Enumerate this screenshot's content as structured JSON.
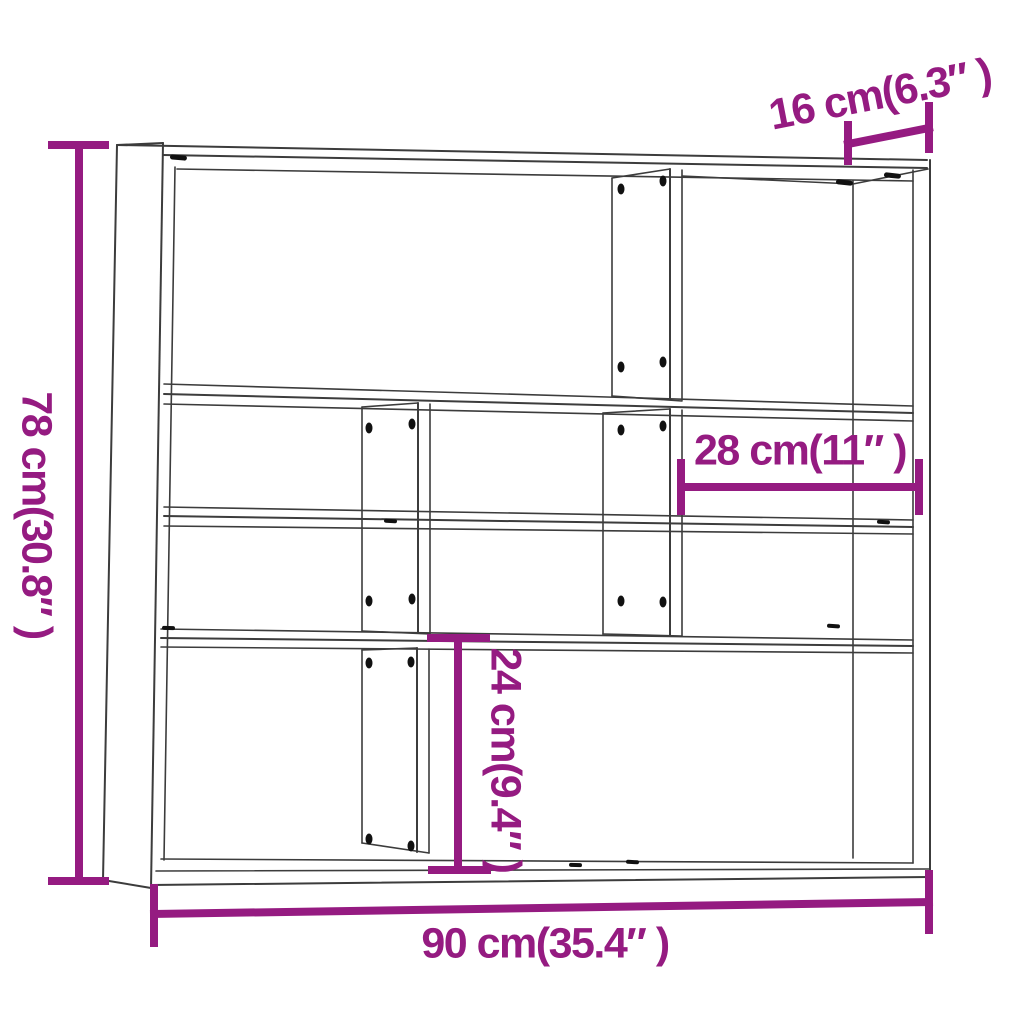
{
  "page": {
    "background": "#ffffff"
  },
  "colors": {
    "dimension": "#951B81",
    "drawing_line": "#3c3c3c",
    "screw": "#111111"
  },
  "product": {
    "name": "wall-shelf",
    "view": "three-quarter line drawing with measurements"
  },
  "dimensions": {
    "width": {
      "label": "90 cm(35.4″ )",
      "cm": 90,
      "inch": 35.4,
      "orientation": "horizontal-bottom"
    },
    "height": {
      "label": "78 cm(30.8″ )",
      "cm": 78,
      "inch": 30.8,
      "orientation": "vertical-left"
    },
    "depth": {
      "label": "16 cm(6.3″ )",
      "cm": 16,
      "inch": 6.3,
      "orientation": "slanted-top-right"
    },
    "compartment_width": {
      "label": "28 cm(11″ )",
      "cm": 28,
      "inch": 11,
      "orientation": "horizontal-middle-right"
    },
    "compartment_height": {
      "label": "24 cm(9.4″ )",
      "cm": 24,
      "inch": 9.4,
      "orientation": "vertical-middle-bottom"
    }
  }
}
